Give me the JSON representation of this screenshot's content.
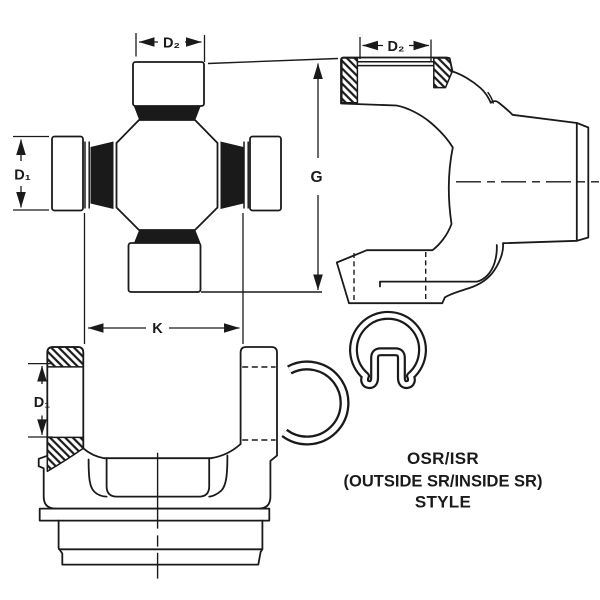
{
  "colors": {
    "background": "#ffffff",
    "line": "#1a1a1a"
  },
  "figures": {
    "cross": {
      "d2_label": "D₂",
      "d1_label": "D₁"
    },
    "end_yoke_side": {
      "d2_label": "D₂",
      "g_label": "G"
    },
    "yoke_front": {
      "k_label": "K",
      "d1_label": "D₁"
    }
  },
  "caption": {
    "line1": "OSR/ISR",
    "line2": "(OUTSIDE SR/INSIDE SR)",
    "line3": "STYLE"
  }
}
